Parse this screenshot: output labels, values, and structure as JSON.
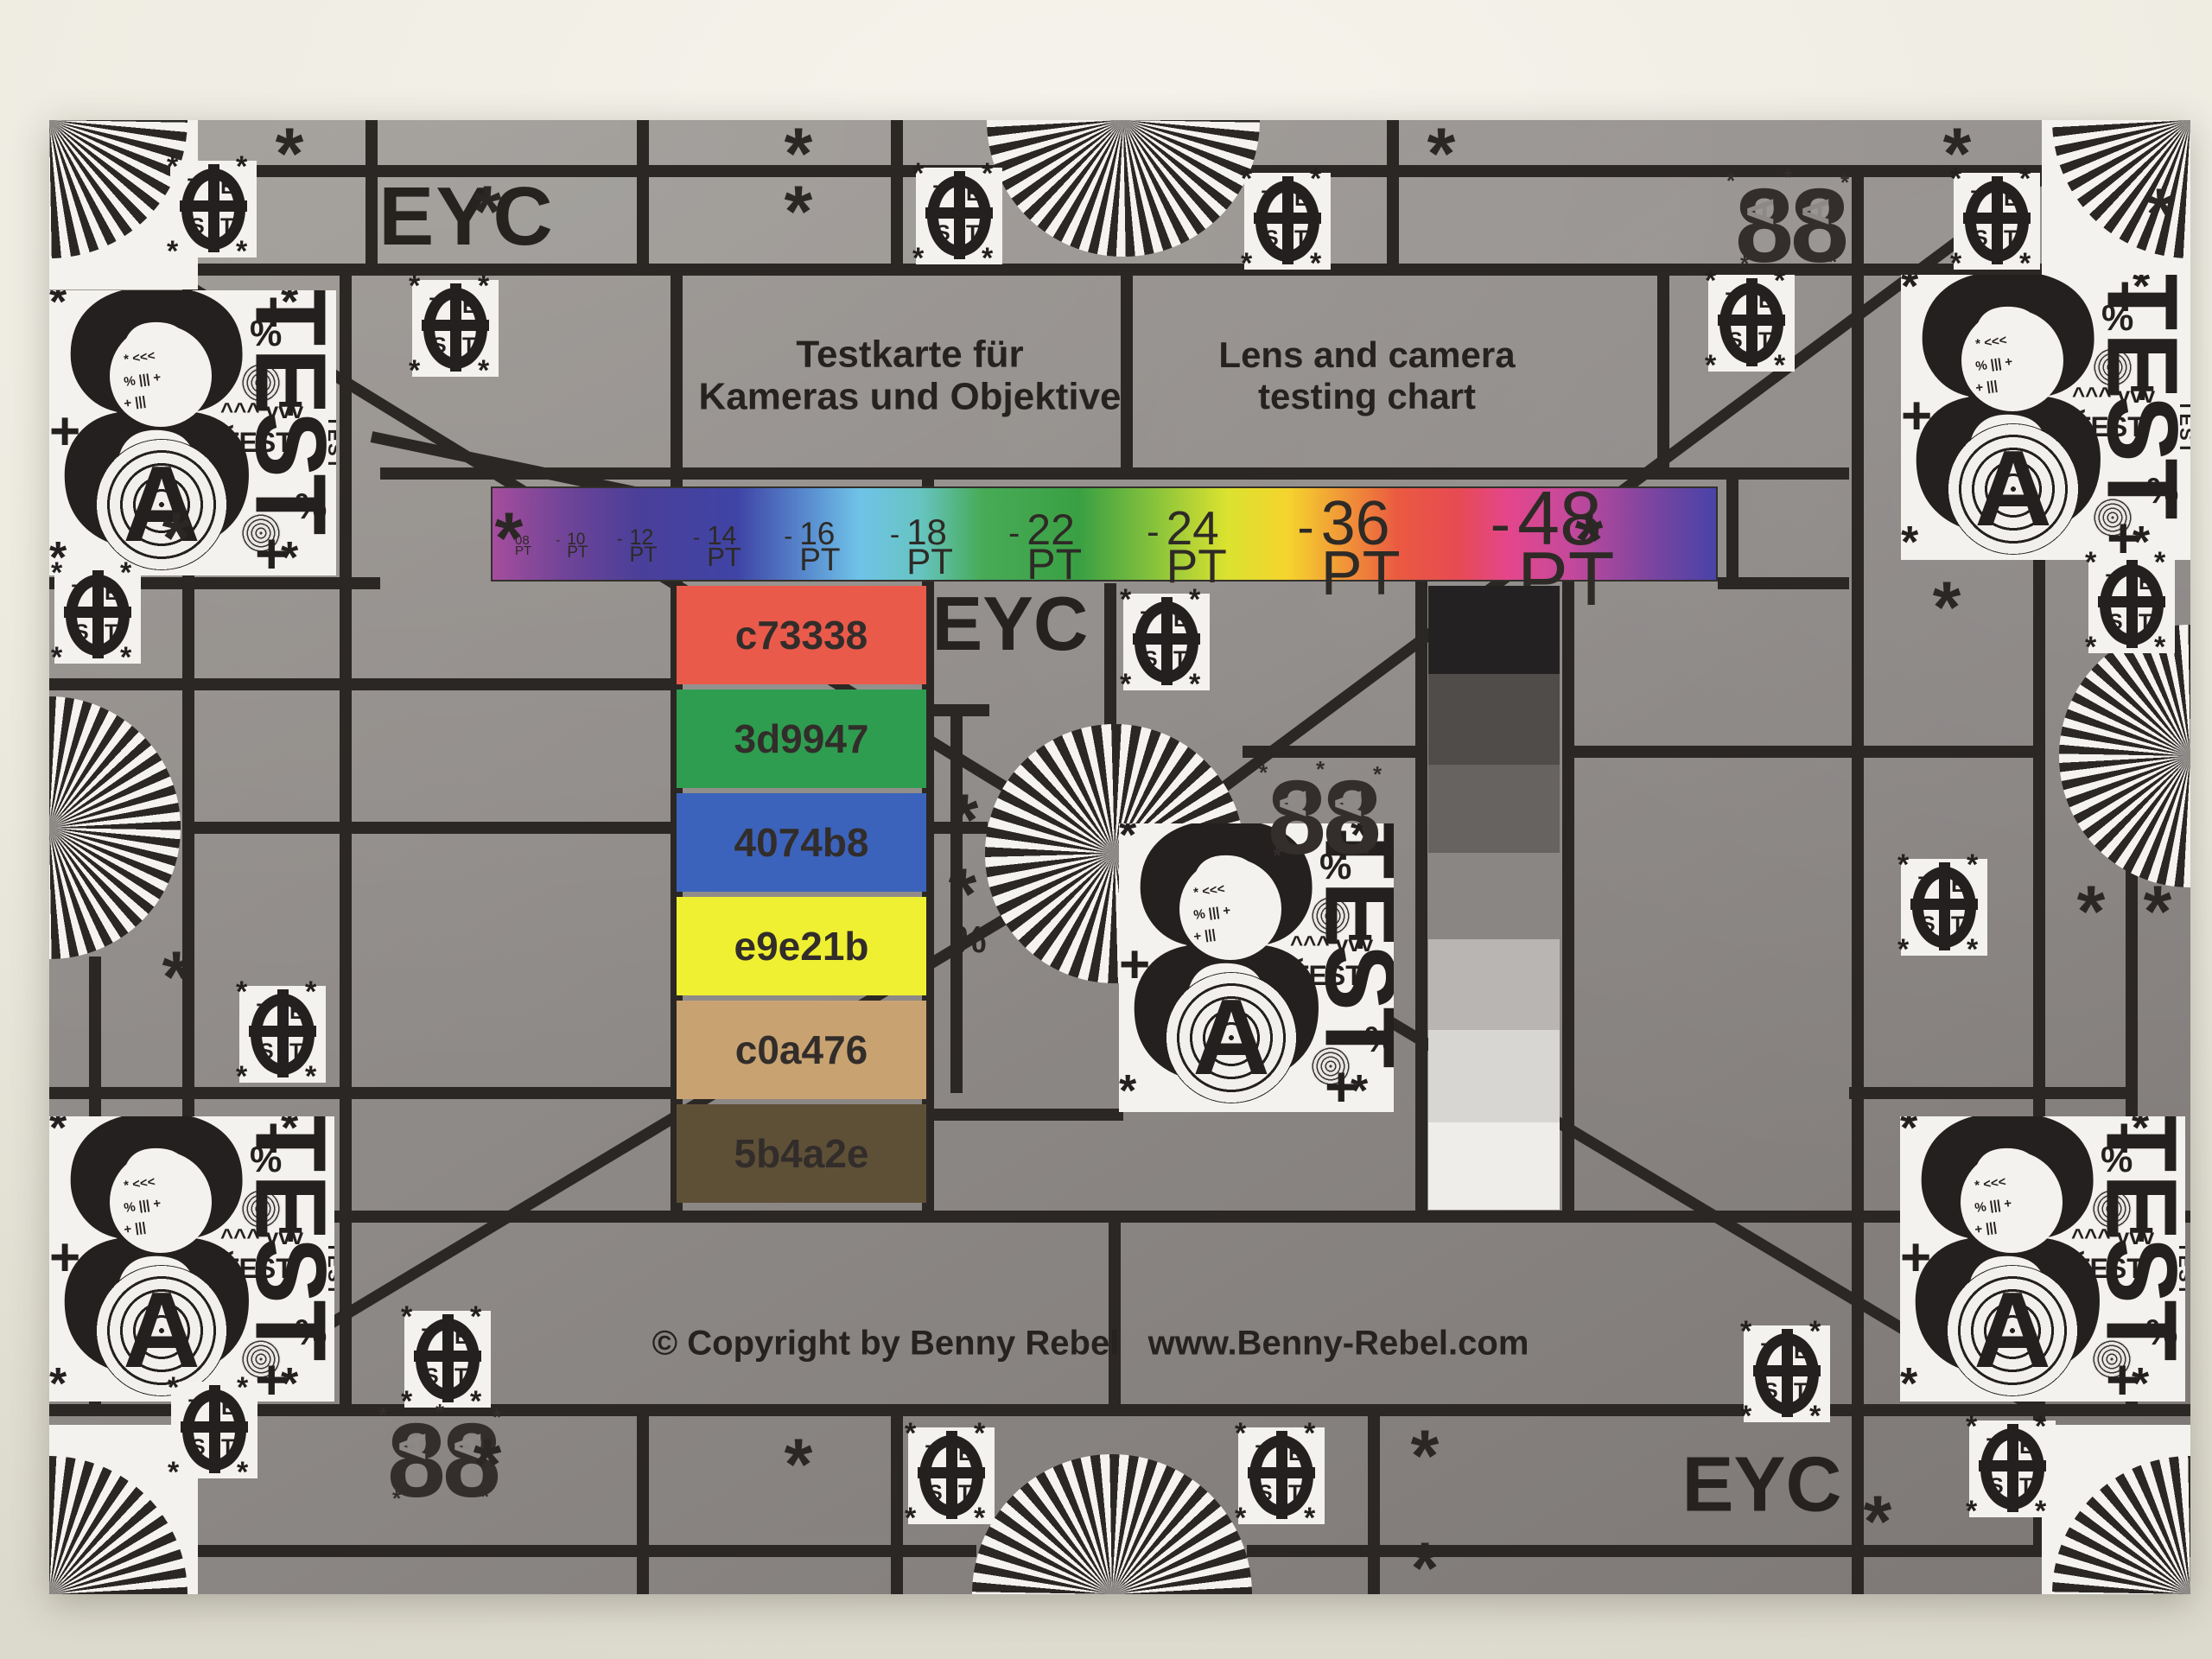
{
  "photo": {
    "description": "Lens and camera testing chart photographed on a cream surface",
    "eyc": "EYC",
    "titles": {
      "de1": "Testkarte für",
      "de2": "Kameras und Objektive",
      "en1": "Lens and camera",
      "en2": "testing chart"
    },
    "copyright": "© Copyright by Benny Rebel",
    "website": "www.Benny-Rebel.com",
    "font_scale": {
      "separator": "-",
      "items": [
        {
          "label": "08 PT",
          "px": 15
        },
        {
          "label": "10 PT",
          "px": 19
        },
        {
          "label": "12 PT",
          "px": 25
        },
        {
          "label": "14 PT",
          "px": 31
        },
        {
          "label": "16 PT",
          "px": 37
        },
        {
          "label": "18 PT",
          "px": 42
        },
        {
          "label": "22 PT",
          "px": 50
        },
        {
          "label": "24 PT",
          "px": 55
        },
        {
          "label": "36 PT",
          "px": 72
        },
        {
          "label": "48 PT",
          "px": 88
        }
      ]
    },
    "color_patches": [
      {
        "label": "c73338",
        "color": "#ea5a4b"
      },
      {
        "label": "3d9947",
        "color": "#2f9d50"
      },
      {
        "label": "4074b8",
        "color": "#3c63bb"
      },
      {
        "label": "e9e21b",
        "color": "#eff031"
      },
      {
        "label": "c0a476",
        "color": "#c8a371"
      },
      {
        "label": "5b4a2e",
        "color": "#5e5037"
      }
    ],
    "grayscale_steps": [
      "#242122",
      "#504c4a",
      "#676361",
      "#8a8684",
      "#b8b5b2",
      "#d8d6d3",
      "#eeede9"
    ],
    "test_logo": {
      "t1": "T",
      "e": "E",
      "s": "S",
      "t2": "T"
    },
    "panel": {
      "eight": "8",
      "a": "A",
      "test_letters": [
        "T",
        "E",
        "S",
        "T"
      ],
      "test_word": "TEST",
      "chevrons": "<<<",
      "arrows": "^^^ vvv",
      "percent": "%",
      "plus": "+",
      "asterisk": "*",
      "micro_lines": [
        "* <<<",
        "% ||| +",
        "+ |||"
      ]
    },
    "eight_a": {
      "eight": "8",
      "a": "A",
      "asterisk": "*"
    },
    "symbols": {
      "asterisk": "*",
      "percent": "%"
    }
  }
}
